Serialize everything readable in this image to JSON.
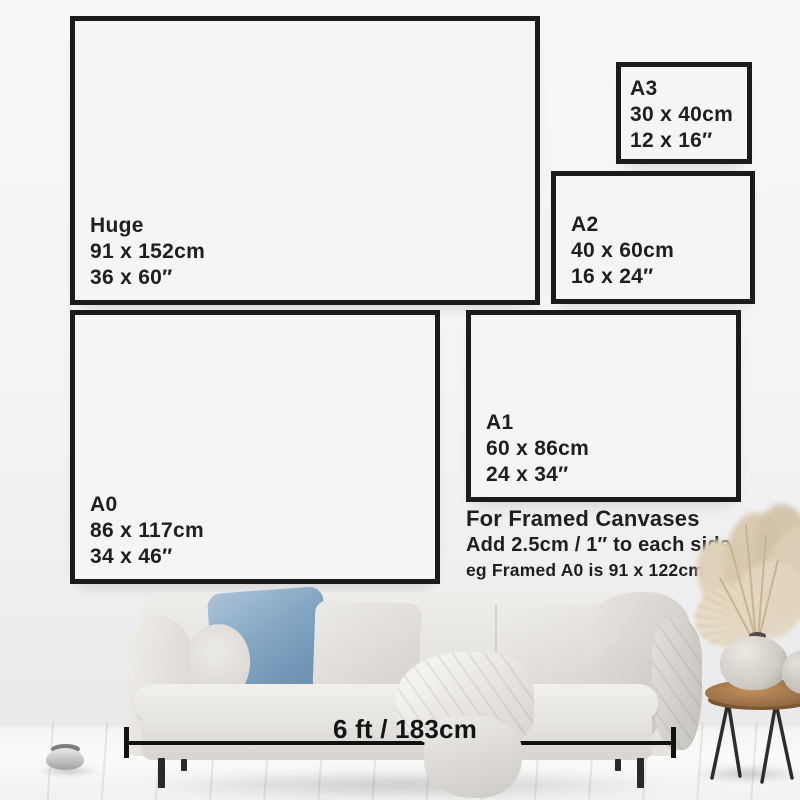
{
  "sizes": [
    {
      "name": "Huge",
      "cm": "91 x 152cm",
      "in": "36 x 60″"
    },
    {
      "name": "A3",
      "cm": "30 x 40cm",
      "in": "12 x 16″"
    },
    {
      "name": "A2",
      "cm": "40 x 60cm",
      "in": "16 x 24″"
    },
    {
      "name": "A0",
      "cm": "86 x 117cm",
      "in": "34 x 46″"
    },
    {
      "name": "A1",
      "cm": "60 x 86cm",
      "in": "24 x 34″"
    }
  ],
  "framed_note": {
    "title": "For Framed Canvases",
    "line1": "Add 2.5cm / 1″ to each side",
    "line2": "eg Framed A0 is 91 x 122cm / 36 x 48″"
  },
  "sofa": {
    "width_label": "6 ft / 183cm"
  },
  "palette": {
    "frame_border": "#1b1b1b",
    "text": "#1f1f1f",
    "wall": "#f5f5f6",
    "blue_pillow": "#85a7c4",
    "sofa_fabric": "#e9e6e2",
    "wood_table": "#9a7047"
  }
}
